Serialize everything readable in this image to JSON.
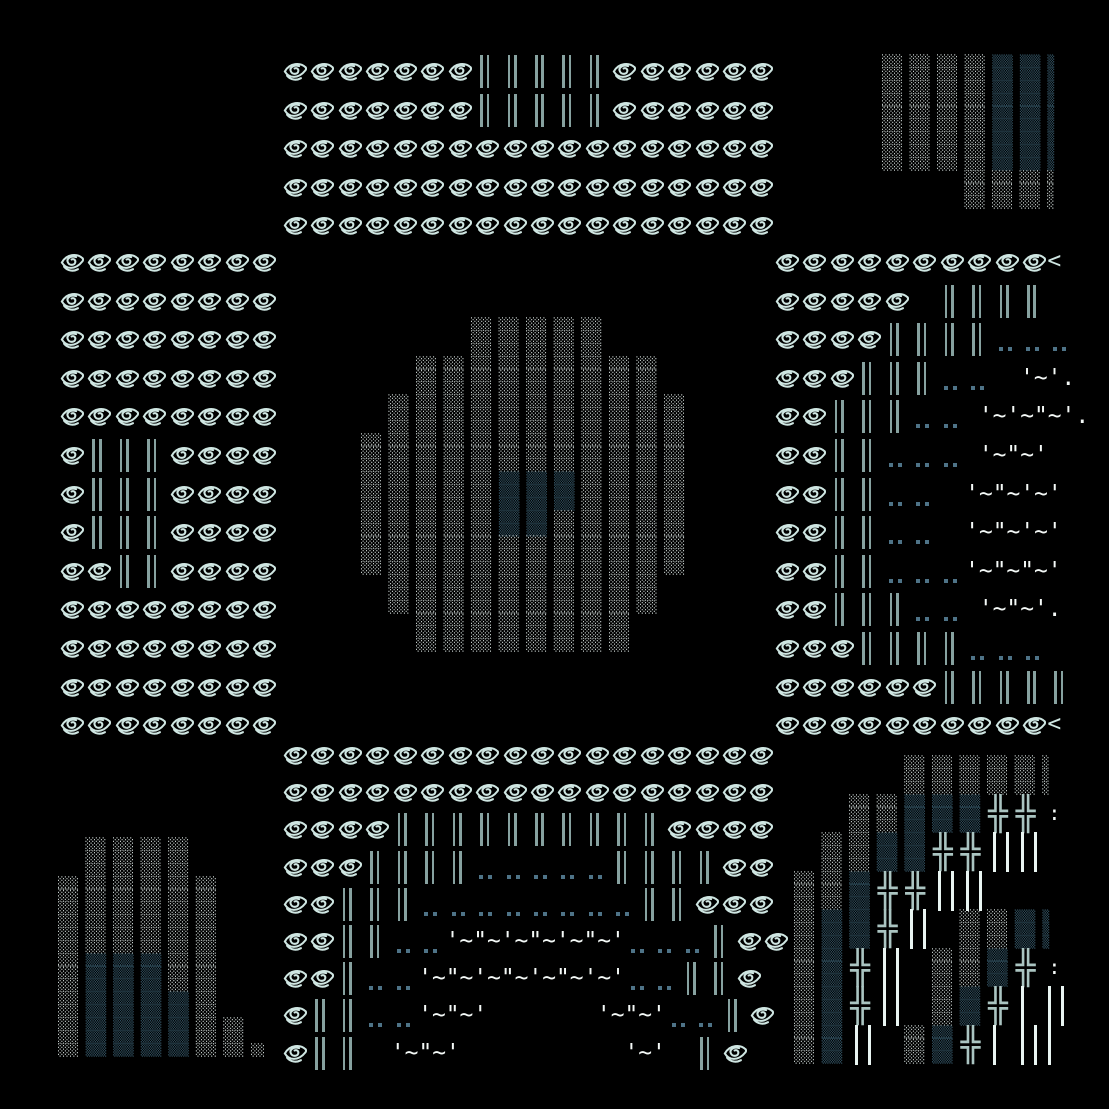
{
  "canvas": {
    "width": 1109,
    "height": 1109,
    "background": "#000000"
  },
  "colors": {
    "eye": "#cfe6e2",
    "bar": "#87a2a0",
    "dot": "#4e7387",
    "white": "#f4f9f7",
    "shade_light": "#dfe9e7",
    "shade_dark": "#2e4c5b",
    "cross": "#aac4c1",
    "bright_bar": "#e9f5f2"
  },
  "eye_glyph": {
    "viewbox": "0 0 28 26",
    "stroke_width": 2.2,
    "paths": [
      "M26.5 8.5 C 21 3.2, 9.5 3.2, 4.2 13",
      "M4.2 13 C 8.5 20.5, 18.5 21.5, 26.5 11.5 C 27 10.6, 27 9.3, 26.5 8.5",
      "M6.5 17.5 C 10.5 22.2, 16.5 23, 21.5 20.2",
      "M19.5 7.2 C 13 5.4, 8.6 9.2, 10.8 13.2 C 12.6 16.4, 17.8 16.2, 18.6 12.8 C 19.2 10.2, 16.6 8.6, 14.6 9.8"
    ]
  },
  "panels": {
    "top_center": {
      "x": 281,
      "y": 52,
      "row_h": 38.6,
      "rows": [
        [
          "e:7",
          "b:5",
          "e:6"
        ],
        [
          "e:7",
          "b:5",
          "e:6"
        ],
        [
          "e:18"
        ],
        [
          "e:18"
        ],
        [
          "e:18"
        ]
      ]
    },
    "left_middle": {
      "x": 58,
      "y": 243,
      "row_h": 38.6,
      "rows": [
        [
          "e:8"
        ],
        [
          "e:8"
        ],
        [
          "e:8"
        ],
        [
          "e:8"
        ],
        [
          "e:8"
        ],
        [
          "e:1",
          "b:3",
          "e:4"
        ],
        [
          "e:1",
          "b:3",
          "e:4"
        ],
        [
          "e:1",
          "b:3",
          "e:4"
        ],
        [
          "e:2",
          "b:2",
          "e:4"
        ],
        [
          "e:8"
        ],
        [
          "e:8"
        ],
        [
          "e:8"
        ],
        [
          "e:8"
        ]
      ]
    },
    "right_middle": {
      "x": 773,
      "y": 243,
      "row_h": 38.6,
      "rows": [
        [
          "e:10",
          "g:<"
        ],
        [
          "e:5",
          "sp:1",
          "b:4"
        ],
        [
          "e:4",
          "b:4",
          "d:3"
        ],
        [
          "e:3",
          "b:3",
          "d:2",
          "w:  '~'."
        ],
        [
          "e:2",
          "b:3",
          "d:2",
          "w: '~'~\"~'."
        ],
        [
          "e:2",
          "b:2",
          "d:3",
          "w: '~\"~'"
        ],
        [
          "e:2",
          "b:2",
          "d:2",
          "w:  '~\"~'~'"
        ],
        [
          "e:2",
          "b:2",
          "d:2",
          "w:  '~\"~'~'"
        ],
        [
          "e:2",
          "b:2",
          "d:3",
          "w:'~\"~\"~'"
        ],
        [
          "e:2",
          "b:3",
          "d:2",
          "w: '~\"~'."
        ],
        [
          "e:3",
          "b:4",
          "d:3"
        ],
        [
          "e:6",
          "b:5"
        ],
        [
          "e:10",
          "g:<"
        ]
      ]
    },
    "bottom_center": {
      "x": 281,
      "y": 736,
      "row_h": 37.2,
      "rows": [
        [
          "e:18"
        ],
        [
          "e:18"
        ],
        [
          "e:4",
          "b:10",
          "e:4"
        ],
        [
          "e:3",
          "b:4",
          "d:5",
          "b:4",
          "e:2"
        ],
        [
          "e:2",
          "b:3",
          "d:8",
          "b:2",
          "e:3"
        ],
        [
          "e:2",
          "b:2",
          "d:2",
          "w:'~\"~'~\"~'~\"~'",
          "d:3",
          "b:1",
          "e:2"
        ],
        [
          "e:2",
          "b:1",
          "d:2",
          "w:'~\"~'~\"~'~\"~'~'",
          "d:2",
          "b:2",
          "e:1"
        ],
        [
          "e:1",
          "b:2",
          "d:2",
          "w:'~\"~'",
          "sp:4",
          "w:'~\"~'",
          "d:2",
          "b:1",
          "e:1"
        ],
        [
          "e:1",
          "b:2",
          "w:  '~\"~'",
          "sp:6",
          "w:'~'",
          "sp:1",
          "b:1",
          "e:1"
        ]
      ]
    },
    "top_right_shade": {
      "x": 882,
      "y": 55,
      "lines": [
        "░░░ ░░░ ░░░ ░░░ ▒▒▒ ▒▒▒ ▒",
        "░░░ ░░░ ░░░ ░░░ ▒▒▒ ▒▒▒ ▒",
        "░░░ ░░░ ░░░ ░░░ ▒▒▒ ▒▒▒ ▒",
        "░░░ ░░░ ░░░ ░░░ ▒▒▒ ▒▒▒ ▒",
        "░░░ ░░░ ░░░ ░░░ ▒▒▒ ▒▒▒ ▒",
        "░░░ ░░░ ░░░ ░░░ ▒▒▒ ▒▒▒ ▒",
        "░░░ ░░░ ░░░ ░░░ ▒▒▒ ▒▒▒ ▒",
        "░░░ ░░░ ░░░ ░░░ ▒▒▒ ▒▒▒ ▒",
        "░░░ ░░░ ░░░ ░░░ ▒▒▒ ▒▒▒ ▒",
        "            ░░░ ░░░ ░░░ ░",
        "            ░░░ ░░░ ░░░ ░",
        "            ░░░ ░░░ ░░░ ░"
      ]
    },
    "center_blob_shade": {
      "x": 361,
      "y": 318,
      "lines": [
        "                ░░░ ░░░ ░░░ ░░░ ░░░             ",
        "                ░░░ ░░░ ░░░ ░░░ ░░░             ",
        "                ░░░ ░░░ ░░░ ░░░ ░░░             ",
        "        ░░░ ░░░ ░░░ ░░░ ░░░ ░░░ ░░░ ░░░ ░░░     ",
        "        ░░░ ░░░ ░░░ ░░░ ░░░ ░░░ ░░░ ░░░ ░░░     ",
        "        ░░░ ░░░ ░░░ ░░░ ░░░ ░░░ ░░░ ░░░ ░░░     ",
        "    ░░░ ░░░ ░░░ ░░░ ░░░ ░░░ ░░░ ░░░ ░░░ ░░░ ░░░ ",
        "    ░░░ ░░░ ░░░ ░░░ ░░░ ░░░ ░░░ ░░░ ░░░ ░░░ ░░░ ",
        "    ░░░ ░░░ ░░░ ░░░ ░░░ ░░░ ░░░ ░░░ ░░░ ░░░ ░░░ ",
        "░░░ ░░░ ░░░ ░░░ ░░░ ░░░ ░░░ ░░░ ░░░ ░░░ ░░░ ░░░ ",
        "░░░ ░░░ ░░░ ░░░ ░░░ ░░░ ░░░ ░░░ ░░░ ░░░ ░░░ ░░░ ",
        "░░░ ░░░ ░░░ ░░░ ░░░ ░░░ ░░░ ░░░ ░░░ ░░░ ░░░ ░░░ ",
        "░░░ ░░░ ░░░ ░░░ ░░░ ▒▒▒ ▒▒▒ ▒▒▒ ░░░ ░░░ ░░░ ░░░ ",
        "░░░ ░░░ ░░░ ░░░ ░░░ ▒▒▒ ▒▒▒ ▒▒▒ ░░░ ░░░ ░░░ ░░░ ",
        "░░░ ░░░ ░░░ ░░░ ░░░ ▒▒▒ ▒▒▒ ▒▒▒ ░░░ ░░░ ░░░ ░░░ ",
        "░░░ ░░░ ░░░ ░░░ ░░░ ▒▒▒ ▒▒▒ ░░░ ░░░ ░░░ ░░░ ░░░ ",
        "░░░ ░░░ ░░░ ░░░ ░░░ ▒▒▒ ▒▒▒ ░░░ ░░░ ░░░ ░░░ ░░░ ",
        "░░░ ░░░ ░░░ ░░░ ░░░ ░░░ ░░░ ░░░ ░░░ ░░░ ░░░ ░░░ ",
        "░░░ ░░░ ░░░ ░░░ ░░░ ░░░ ░░░ ░░░ ░░░ ░░░ ░░░ ░░░ ",
        "░░░ ░░░ ░░░ ░░░ ░░░ ░░░ ░░░ ░░░ ░░░ ░░░ ░░░ ░░░ ",
        "    ░░░ ░░░ ░░░ ░░░ ░░░ ░░░ ░░░ ░░░ ░░░ ░░░     ",
        "    ░░░ ░░░ ░░░ ░░░ ░░░ ░░░ ░░░ ░░░ ░░░ ░░░     ",
        "    ░░░ ░░░ ░░░ ░░░ ░░░ ░░░ ░░░ ░░░ ░░░ ░░░     ",
        "        ░░░ ░░░ ░░░ ░░░ ░░░ ░░░ ░░░ ░░░         ",
        "        ░░░ ░░░ ░░░ ░░░ ░░░ ░░░ ░░░ ░░░         ",
        "        ░░░ ░░░ ░░░ ░░░ ░░░ ░░░ ░░░ ░░░         "
      ]
    },
    "bottom_left_shade": {
      "x": 58,
      "y": 838,
      "lines": [
        "    ░░░ ░░░ ░░░ ░░░             ",
        "    ░░░ ░░░ ░░░ ░░░             ",
        "    ░░░ ░░░ ░░░ ░░░             ",
        "░░░ ░░░ ░░░ ░░░ ░░░ ░░░         ",
        "░░░ ░░░ ░░░ ░░░ ░░░ ░░░         ",
        "░░░ ░░░ ░░░ ░░░ ░░░ ░░░         ",
        "░░░ ░░░ ░░░ ░░░ ░░░ ░░░         ",
        "░░░ ░░░ ░░░ ░░░ ░░░ ░░░         ",
        "░░░ ░░░ ░░░ ░░░ ░░░ ░░░         ",
        "░░░ ▒▒▒ ▒▒▒ ▒▒▒ ░░░ ░░░         ",
        "░░░ ▒▒▒ ▒▒▒ ▒▒▒ ░░░ ░░░         ",
        "░░░ ▒▒▒ ▒▒▒ ▒▒▒ ░░░ ░░░         ",
        "░░░ ▒▒▒ ▒▒▒ ▒▒▒ ▒▒▒ ░░░         ",
        "░░░ ▒▒▒ ▒▒▒ ▒▒▒ ▒▒▒ ░░░         ",
        "░░░ ▒▒▒ ▒▒▒ ▒▒▒ ▒▒▒ ░░░ ░░░     ",
        "░░░ ▒▒▒ ▒▒▒ ▒▒▒ ▒▒▒ ░░░ ░░░     ",
        "░░░ ▒▒▒ ▒▒▒ ▒▒▒ ▒▒▒ ░░░ ░░░ ░░  "
      ]
    },
    "bottom_right": {
      "x": 794,
      "y": 756,
      "grid": [
        [
          "",
          "",
          "",
          "",
          "L",
          "L",
          "L",
          "L",
          "L",
          "Lp"
        ],
        [
          "",
          "",
          "L",
          "L",
          "S",
          "S",
          "S",
          "x",
          "x",
          ":"
        ],
        [
          "",
          "L",
          "L",
          "S",
          "S",
          "x",
          "x",
          "vv",
          "vv",
          ""
        ],
        [
          "L",
          "L",
          "S",
          "x",
          "x",
          "vv",
          "vv",
          "",
          "",
          ""
        ],
        [
          "L",
          "S",
          "S",
          "x",
          "vv",
          "",
          "L",
          "L",
          "S",
          "Sp"
        ],
        [
          "L",
          "S",
          "x",
          "vv",
          "",
          "L",
          "L",
          "S",
          "x",
          ":"
        ],
        [
          "L",
          "S",
          "x",
          "vv",
          "",
          "L",
          "S",
          "x",
          "v",
          "vv"
        ],
        [
          "L",
          "S",
          "vv",
          "",
          "L",
          "S",
          "x",
          "v",
          "vv",
          "v"
        ]
      ]
    }
  }
}
